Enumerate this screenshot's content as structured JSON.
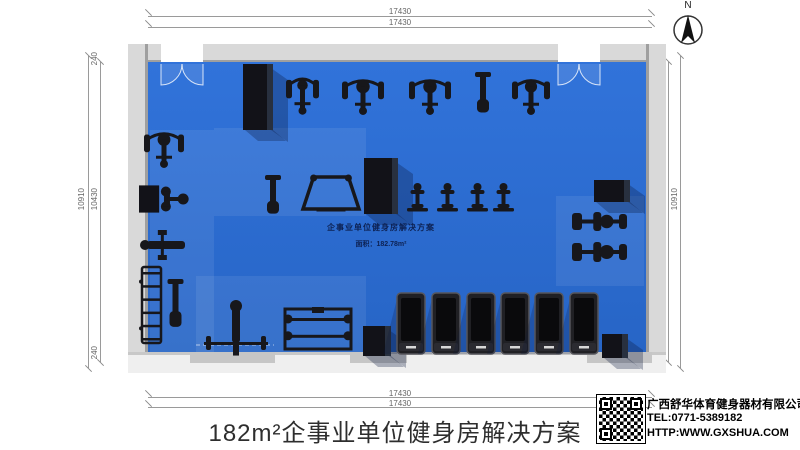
{
  "meta": {
    "title": "182m²企事业单位健身房解决方案"
  },
  "compass": {
    "label": "N"
  },
  "dimensions": {
    "top": [
      "17430",
      "17430"
    ],
    "bottom": [
      "17430",
      "17430"
    ],
    "left": {
      "outer": "10910",
      "inner": "10430",
      "top": "240",
      "bottom": "240"
    },
    "right": {
      "outer": "10910",
      "inner": "10430",
      "top": "240",
      "bottom": "240"
    }
  },
  "floor_label": {
    "line1": "企事业单位健身房解决方案",
    "line2": "面积：182.78m²"
  },
  "footer": {
    "company": "广西舒华体育健身器材有限公司",
    "tel": "TEL:0771-5389182",
    "url": "HTTP:WWW.GXSHUA.COM"
  },
  "colors": {
    "floor": "#2b6dd3",
    "wall": "#d9d9d9",
    "wall_edge": "#9f9f9f",
    "equipment": "#17171b",
    "dimension": "#9a9a9a"
  },
  "floor_plan": {
    "equipment": [
      {
        "name": "pillar-top-left",
        "type": "column",
        "x": 243,
        "y": 64,
        "w": 30,
        "h": 66
      },
      {
        "name": "pillar-center",
        "type": "column",
        "x": 364,
        "y": 158,
        "w": 34,
        "h": 56
      },
      {
        "name": "beam-right",
        "type": "column",
        "x": 594,
        "y": 180,
        "w": 36,
        "h": 22
      },
      {
        "name": "pillar-bottom-center",
        "type": "column",
        "x": 363,
        "y": 326,
        "w": 28,
        "h": 30
      },
      {
        "name": "box-bottom-right",
        "type": "column",
        "x": 602,
        "y": 334,
        "w": 26,
        "h": 24
      },
      {
        "name": "strength-machine-1",
        "type": "machine",
        "x": 286,
        "y": 72,
        "w": 33,
        "h": 44
      },
      {
        "name": "strength-machine-2",
        "type": "machine",
        "x": 342,
        "y": 74,
        "w": 42,
        "h": 42
      },
      {
        "name": "strength-machine-3",
        "type": "machine",
        "x": 409,
        "y": 74,
        "w": 42,
        "h": 42
      },
      {
        "name": "strength-machine-4",
        "type": "bench",
        "x": 464,
        "y": 72,
        "w": 38,
        "h": 44
      },
      {
        "name": "strength-machine-5",
        "type": "machine",
        "x": 512,
        "y": 74,
        "w": 38,
        "h": 42
      },
      {
        "name": "squat-machine",
        "type": "machine",
        "x": 144,
        "y": 127,
        "w": 40,
        "h": 42
      },
      {
        "name": "pec-fly-machine",
        "type": "pec",
        "x": 139,
        "y": 182,
        "w": 48,
        "h": 34
      },
      {
        "name": "bench-press",
        "type": "hbench",
        "x": 139,
        "y": 230,
        "w": 52,
        "h": 30
      },
      {
        "name": "dumbbell-rack",
        "type": "rack",
        "x": 141,
        "y": 266,
        "w": 21,
        "h": 78
      },
      {
        "name": "flat-bench",
        "type": "bench",
        "x": 165,
        "y": 279,
        "w": 21,
        "h": 52
      },
      {
        "name": "adjustable-bench",
        "type": "bench",
        "x": 252,
        "y": 175,
        "w": 42,
        "h": 42
      },
      {
        "name": "power-rack",
        "type": "rig",
        "x": 302,
        "y": 174,
        "w": 58,
        "h": 40
      },
      {
        "name": "spin-bike-1",
        "type": "bike",
        "x": 406,
        "y": 182,
        "w": 23,
        "h": 33
      },
      {
        "name": "spin-bike-2",
        "type": "bike",
        "x": 436,
        "y": 182,
        "w": 23,
        "h": 33
      },
      {
        "name": "spin-bike-3",
        "type": "bike",
        "x": 466,
        "y": 182,
        "w": 23,
        "h": 33
      },
      {
        "name": "spin-bike-4",
        "type": "bike",
        "x": 492,
        "y": 182,
        "w": 23,
        "h": 33
      },
      {
        "name": "rowing-machine-1",
        "type": "hbike",
        "x": 572,
        "y": 211,
        "w": 56,
        "h": 21
      },
      {
        "name": "rowing-machine-2",
        "type": "hbike",
        "x": 572,
        "y": 241,
        "w": 56,
        "h": 22
      },
      {
        "name": "barbell-bench",
        "type": "bbench",
        "x": 204,
        "y": 298,
        "w": 64,
        "h": 58
      },
      {
        "name": "barbell-rack",
        "type": "brack",
        "x": 284,
        "y": 306,
        "w": 68,
        "h": 48
      },
      {
        "name": "treadmill-1",
        "type": "treadmill",
        "x": 397,
        "y": 293,
        "w": 28,
        "h": 61
      },
      {
        "name": "treadmill-2",
        "type": "treadmill",
        "x": 432,
        "y": 293,
        "w": 28,
        "h": 61
      },
      {
        "name": "treadmill-3",
        "type": "treadmill",
        "x": 467,
        "y": 293,
        "w": 28,
        "h": 61
      },
      {
        "name": "treadmill-4",
        "type": "treadmill",
        "x": 501,
        "y": 293,
        "w": 28,
        "h": 61
      },
      {
        "name": "treadmill-5",
        "type": "treadmill",
        "x": 535,
        "y": 293,
        "w": 28,
        "h": 61
      },
      {
        "name": "treadmill-6",
        "type": "treadmill",
        "x": 570,
        "y": 293,
        "w": 28,
        "h": 61
      }
    ]
  }
}
